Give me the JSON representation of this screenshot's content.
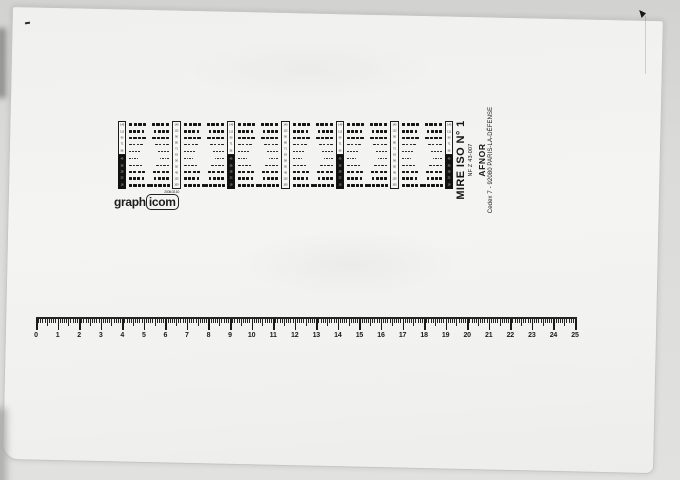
{
  "scan": {
    "publisher": {
      "title": "MIRE ISO N° 1",
      "standard": "NF Z 43-007",
      "org": "AFNOR",
      "address": "Cedex 7 - 92080 PARIS-LA-DÉFENSE"
    },
    "logo": {
      "prefix": "graph",
      "boxed": "icom",
      "stamp": "2006.02.10"
    },
    "strip": {
      "id_bar_top": [
        "140",
        "112",
        "90",
        "71",
        "56"
      ],
      "id_bar_bottom": [
        "45",
        "36",
        "28",
        "22",
        "18"
      ],
      "scale_bar": [
        "140",
        "112",
        "90",
        "80",
        "71",
        "63",
        "56",
        "50",
        "45",
        "125",
        "100"
      ],
      "blocks": 6,
      "rows": [
        {
          "w": 3.3,
          "h": 3.1,
          "n": 4,
          "g": 1.4
        },
        {
          "w": 2.9,
          "h": 2.7,
          "n": 4,
          "g": 1.3
        },
        {
          "w": 3.3,
          "h": 1.5,
          "n": 4,
          "g": 1.2
        },
        {
          "w": 2.7,
          "h": 1.2,
          "n": 4,
          "g": 1.1
        },
        {
          "w": 2.1,
          "h": 1.0,
          "n": 4,
          "g": 1.0
        },
        {
          "w": 1.7,
          "h": 0.9,
          "n": 4,
          "g": 0.9
        },
        {
          "w": 2.5,
          "h": 1.1,
          "n": 4,
          "g": 1.0
        },
        {
          "w": 3.1,
          "h": 1.6,
          "n": 4,
          "g": 1.2
        },
        {
          "w": 2.9,
          "h": 2.8,
          "n": 4,
          "g": 1.3
        },
        {
          "w": 3.2,
          "h": 3.1,
          "n": 5,
          "g": 1.2
        }
      ]
    },
    "ruler": {
      "unit": "cm",
      "cm_px": 21.56,
      "labels": [
        "0",
        "1",
        "2",
        "3",
        "4",
        "5",
        "6",
        "7",
        "8",
        "9",
        "10",
        "11",
        "12",
        "13",
        "14",
        "15",
        "16",
        "17",
        "18",
        "19",
        "20",
        "21",
        "22",
        "23",
        "24",
        "25"
      ]
    },
    "icons": {
      "corner_arrow_icon": "small black arrowhead",
      "registration_dash_mark": "short black dash"
    },
    "colors": {
      "page": "#f3f3f1",
      "background": "#dbdbd9",
      "ink": "#161616"
    }
  }
}
